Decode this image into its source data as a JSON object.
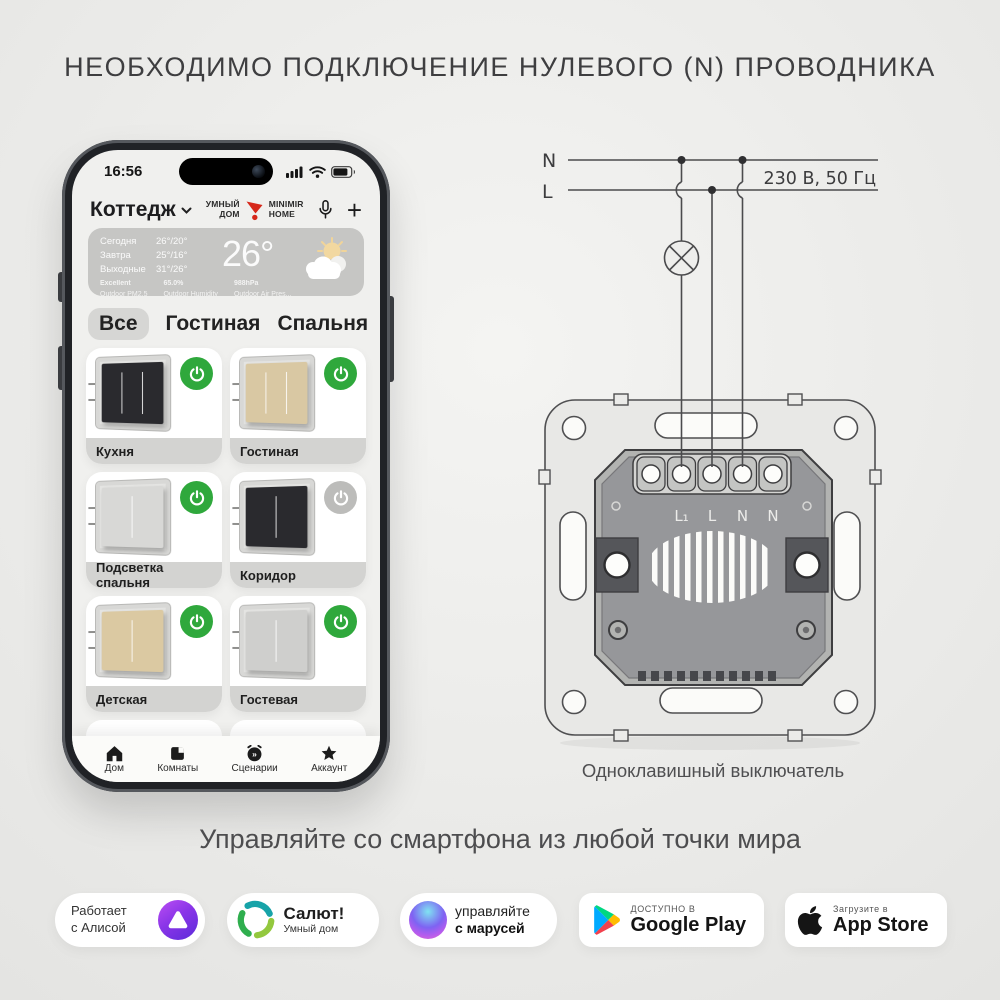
{
  "title": "НЕОБХОДИМО ПОДКЛЮЧЕНИЕ НУЛЕВОГО (N) ПРОВОДНИКА",
  "subtitle": "Управляйте со смартфона из любой точки мира",
  "phone": {
    "status": {
      "time": "16:56"
    },
    "header": {
      "home_name": "Коттедж",
      "brand_left": "УМНЫЙ\nДОМ",
      "brand_left_1": "УМНЫЙ",
      "brand_left_2": "ДОМ",
      "brand_right_1": "MINIMIR",
      "brand_right_2": "HOME",
      "plus_label": "+"
    },
    "weather": {
      "forecast": [
        {
          "label": "Сегодня",
          "temp": "26°/20°"
        },
        {
          "label": "Завтра",
          "temp": "25°/16°"
        },
        {
          "label": "Выходные",
          "temp": "31°/26°"
        }
      ],
      "current_temp": "26°",
      "stats": [
        {
          "value": "Excellent",
          "label": "Outdoor PM2.5"
        },
        {
          "value": "65.0%",
          "label": "Outdoor Humidity"
        },
        {
          "value": "988hPa",
          "label": "Outdoor Air Pres..."
        }
      ]
    },
    "tabs": [
      {
        "label": "Все"
      },
      {
        "label": "Гостиная"
      },
      {
        "label": "Спальня"
      },
      {
        "label": "Коридор"
      }
    ],
    "cards": [
      {
        "label": "Кухня",
        "switch_color": "#2a2a2e",
        "badge_color": "#2fa83c",
        "state": "on"
      },
      {
        "label": "Гостиная",
        "switch_color": "#d9c8a3",
        "badge_color": "#2fa83c",
        "state": "on"
      },
      {
        "label": "Подсветка спальня",
        "switch_color": "#d8d8d6",
        "badge_color": "#2fa83c",
        "state": "on"
      },
      {
        "label": "Коридор",
        "switch_color": "#2a2a2e",
        "badge_color": "#bcbcba",
        "state": "off"
      },
      {
        "label": "Детская",
        "switch_color": "#dbc9a2",
        "badge_color": "#2fa83c",
        "state": "on"
      },
      {
        "label": "Гостевая",
        "switch_color": "#cfcfcd",
        "badge_color": "#2fa83c",
        "state": "on"
      }
    ],
    "nav": [
      {
        "label": "Дом"
      },
      {
        "label": "Комнаты"
      },
      {
        "label": "Сценарии"
      },
      {
        "label": "Аккаунт"
      }
    ]
  },
  "diagram": {
    "n_label": "N",
    "l_label": "L",
    "voltage": "230 В, 50 Гц",
    "terminals": [
      "L₁",
      "L",
      "N",
      "N"
    ],
    "caption": "Одноклавишный выключатель"
  },
  "badges": [
    {
      "name": "alice",
      "line1": "Работает",
      "line2": "с Алисой"
    },
    {
      "name": "salut",
      "title": "Салют!",
      "subtitle": "Умный дом"
    },
    {
      "name": "marusia",
      "line1": "управляйте",
      "line2": "с марусей"
    },
    {
      "name": "google-play",
      "line1": "ДОСТУПНО В",
      "line2": "Google Play"
    },
    {
      "name": "app-store",
      "line1": "Загрузите в",
      "line2": "App Store"
    }
  ],
  "colors": {
    "accent_green": "#2fa83c",
    "off_gray": "#bcbcba",
    "brand_red": "#d6281a"
  }
}
